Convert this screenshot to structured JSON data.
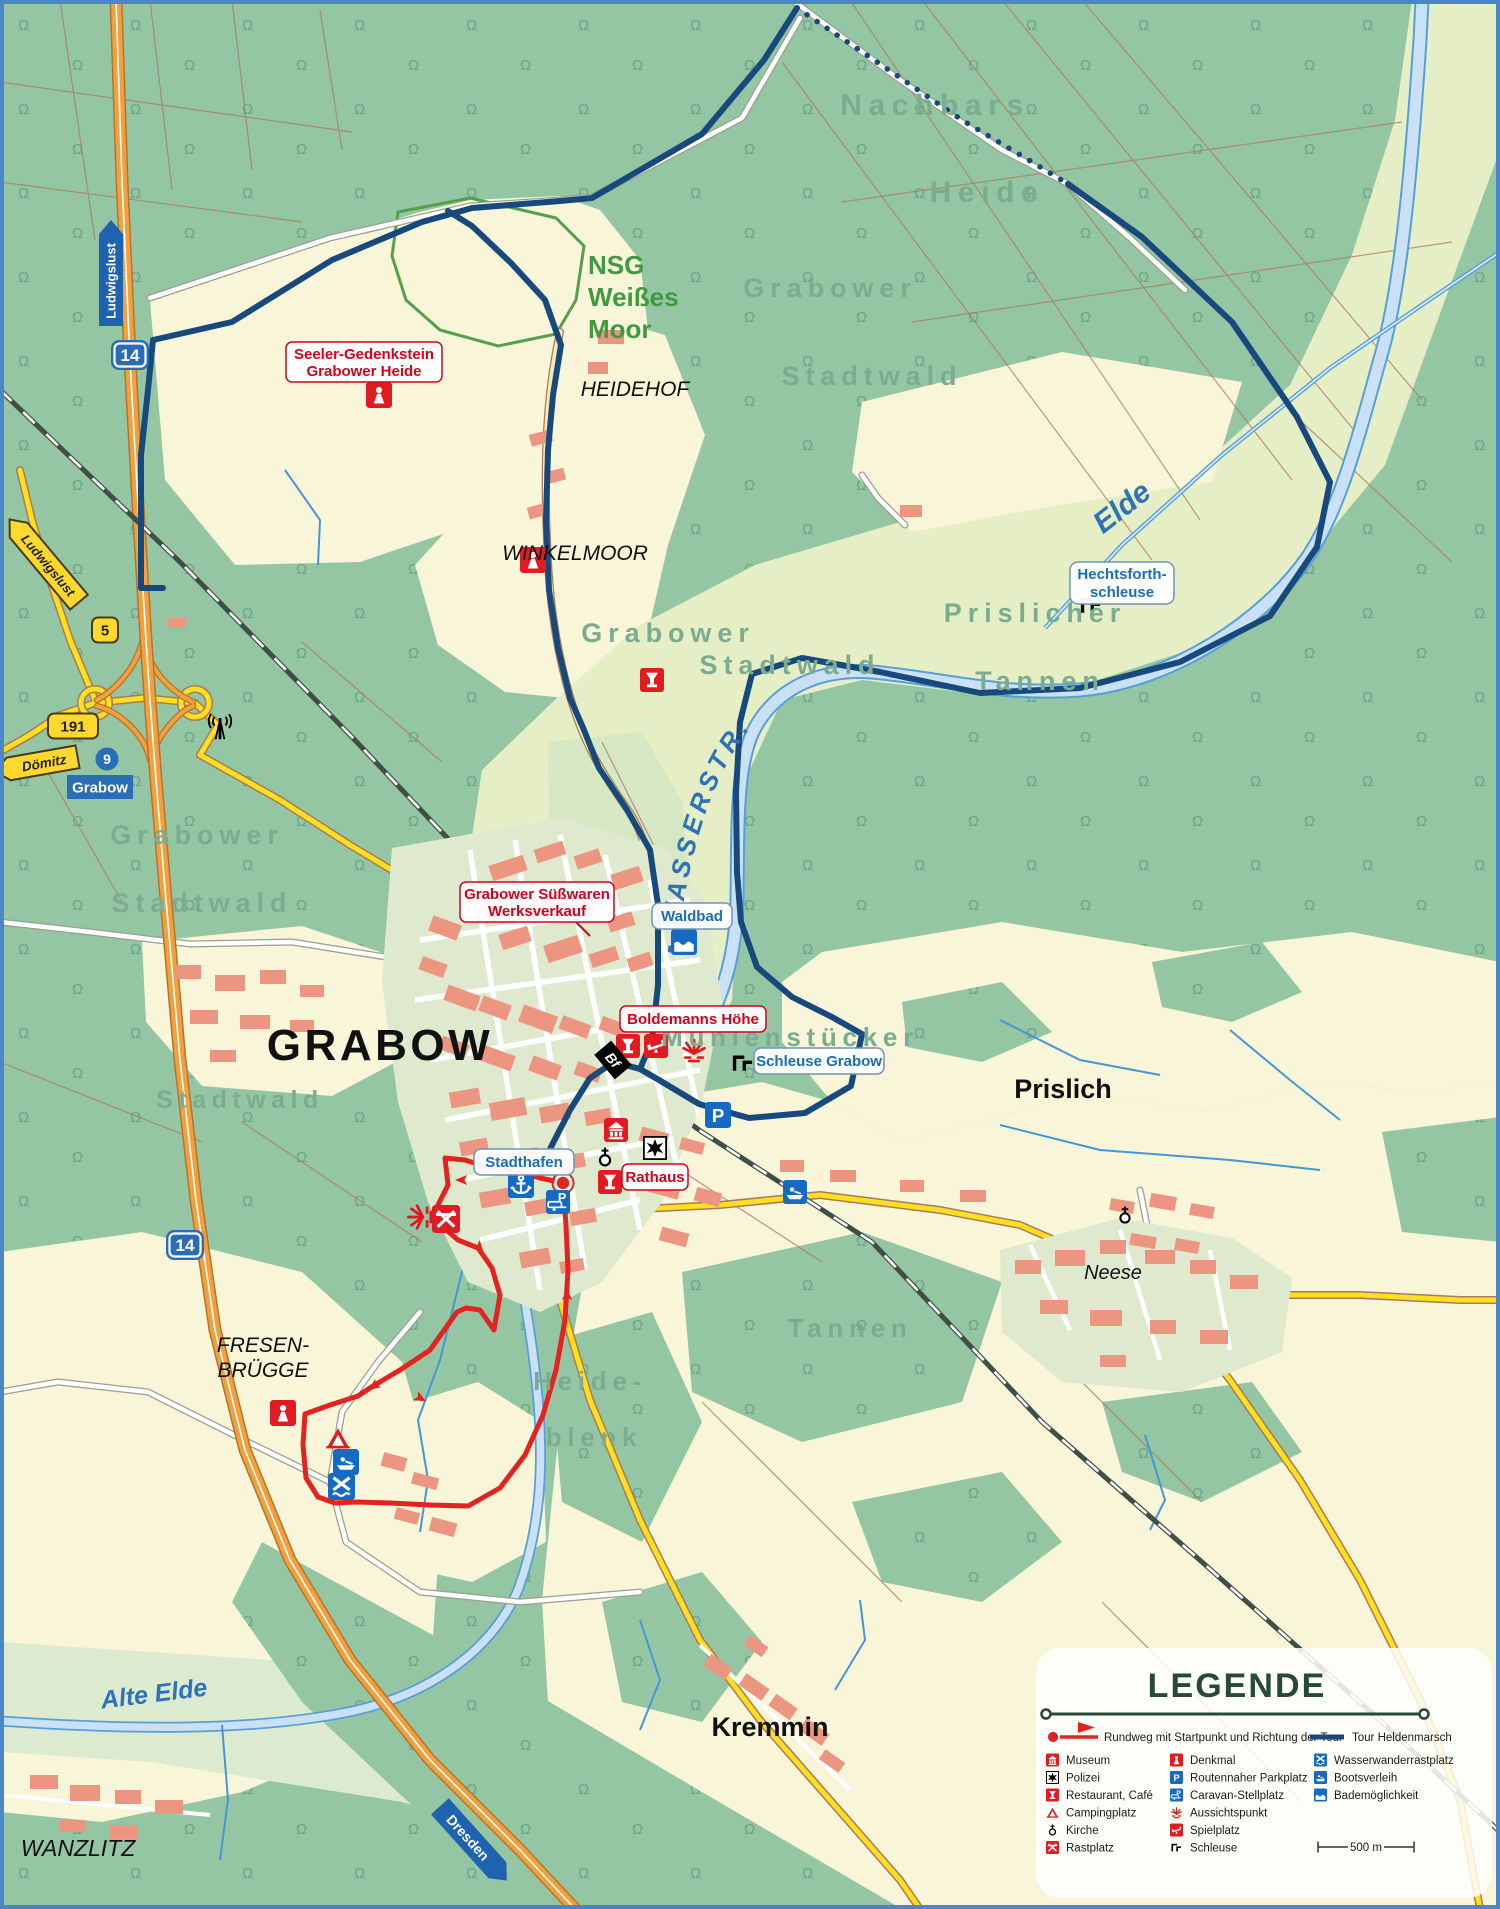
{
  "colors": {
    "forest": "#95c6a4",
    "field": "#f8f5d8",
    "corridor": "#e6eec6",
    "water_fill": "#c9e0f5",
    "water_line": "#569fd8",
    "tour_blue": "#17497d",
    "rundweg_red": "#e2231f",
    "motorway_orange": "#f2a03e",
    "road_yellow": "#ffdf1e",
    "label_forest": "#7cac90",
    "label_water": "#2f72b8",
    "label_red": "#d6001c",
    "label_blue": "#1a6db8",
    "nsg_green": "#3f9a41"
  },
  "labels": {
    "grabow": "GRABOW",
    "heidehof": "HEIDEHOF",
    "winkelmoor": "WINKELMOOR",
    "fresen_1": "FRESEN-",
    "fresen_2": "BRÜGGE",
    "wanzlitz": "WANZLITZ",
    "kremmin": "Kremmin",
    "prislich": "Prislich",
    "neese": "Neese",
    "nachbars": "Nachbars",
    "heide": "Heide",
    "grabower": "Grabower",
    "stadtwald": "Stadtwald",
    "prislicher": "Prislicher",
    "tannen": "Tannen",
    "muehlenstuecker": "Mühlenstücker",
    "heideblenk_1": "Heide-",
    "heideblenk_2": "blenk",
    "elde": "Elde",
    "alte_elde": "Alte Elde",
    "wasserstrasse": "MÜRITZ- ELDE- WASSERSTR.",
    "nsg_1": "NSG",
    "nsg_2": "Weißes",
    "nsg_3": "Moor"
  },
  "poi": {
    "seeler_1": "Seeler-Gedenkstein",
    "seeler_2": "Grabower Heide",
    "suesswaren_1": "Grabower Süßwaren",
    "suesswaren_2": "Werksverkauf",
    "boldemanns": "Boldemanns Höhe",
    "rathaus": "Rathaus",
    "waldbad": "Waldbad",
    "hechtsforth_1": "Hechtsforth-",
    "hechtsforth_2": "schleuse",
    "schleuse_grabow": "Schleuse Grabow",
    "stadthafen": "Stadthafen"
  },
  "badges": {
    "a14": "14",
    "b5": "5",
    "b191": "191",
    "exit_number": "9",
    "exit_name": "Grabow",
    "dir_ludwigslust": "Ludwigslust",
    "dir_doemitz": "Dömitz",
    "dir_dresden": "Dresden",
    "station": "Bf"
  },
  "legend": {
    "title": "LEGENDE",
    "route_rundweg": "Rundweg mit Startpunkt und Richtung der Tour",
    "route_tour": "Tour Heldenmarsch",
    "items_col1": [
      "Museum",
      "Polizei",
      "Restaurant, Café",
      "Campingplatz",
      "Kirche",
      "Rastplatz"
    ],
    "items_col2": [
      "Denkmal",
      "Routennaher Parkplatz",
      "Caravan-Stellplatz",
      "Aussichtspunkt",
      "Spielplatz",
      "Schleuse"
    ],
    "items_col3": [
      "Wasserwanderrastplatz",
      "Bootsverleih",
      "Bademöglichkeit"
    ],
    "scale_label": "500 m"
  }
}
